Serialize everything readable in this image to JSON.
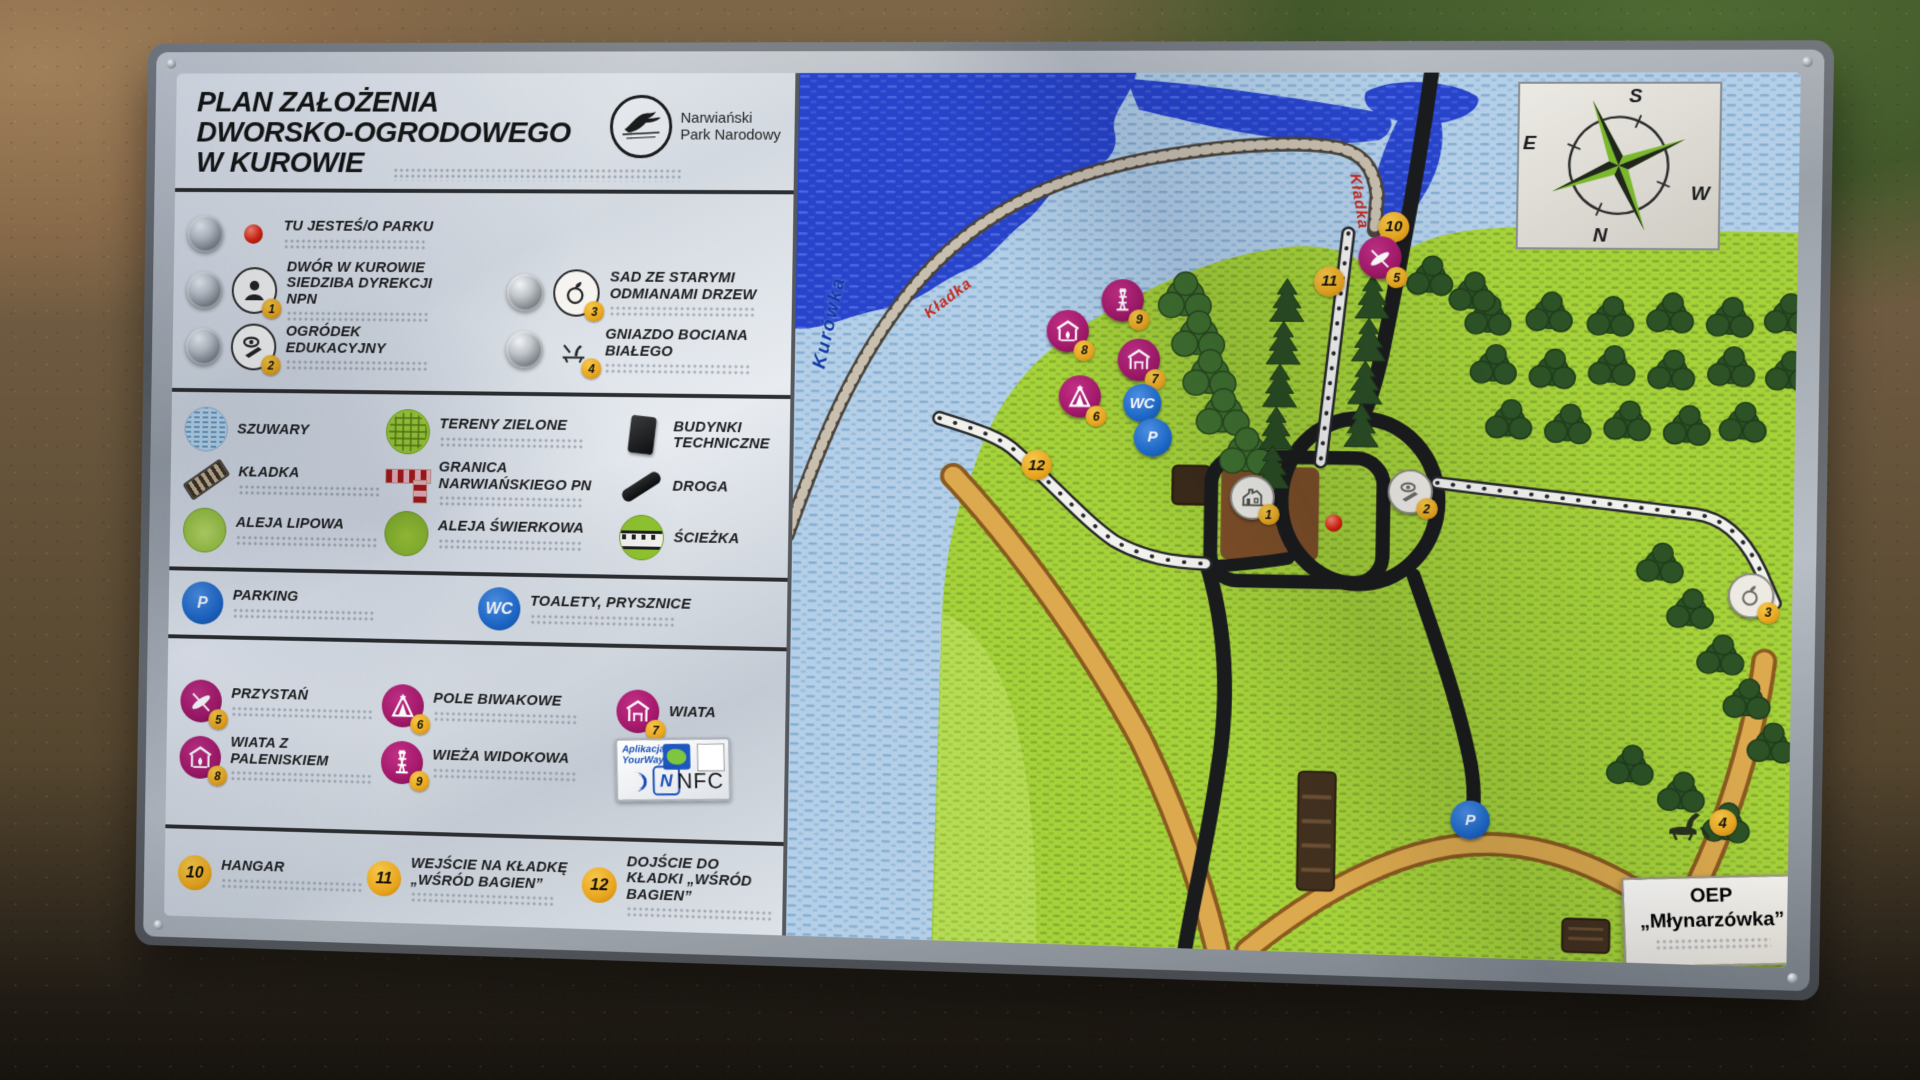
{
  "board": {
    "title_lines": [
      "PLAN ZAŁOŻENIA",
      "DWORSKO-OGRODOWEGO",
      "W KUROWIE"
    ],
    "logo": {
      "park_name_lines": [
        "Narwiański",
        "Park Narodowy"
      ]
    }
  },
  "colors": {
    "magenta": "#a4196b",
    "badge_yellow": "#e9a61f",
    "blue": "#1e6bcc",
    "land_green": "#a5d23a",
    "water_light": "#b7d0e6",
    "river_blue": "#2a47cf",
    "path_orange": "#d9a44a",
    "road_black": "#1a1b1d",
    "red_dot": "#e02412"
  },
  "legend": {
    "sections": [
      {
        "id": "s1",
        "metal": true,
        "items": [
          {
            "icon": "you-are-here",
            "label": "TU JESTEŚ/O PARKU",
            "wide": true,
            "braille": true
          },
          {
            "icon": "poi-dwor",
            "badge": "1",
            "label": "DWÓR W KUROWIE SIEDZIBA DYREKCJI NPN",
            "braille": true
          },
          {
            "icon": "poi-sad",
            "badge": "3",
            "label": "SAD ZE STARYMI ODMIANAMI DRZEW",
            "braille": true
          },
          {
            "icon": "poi-ogrodek",
            "badge": "2",
            "label": "OGRÓDEK EDUKACYJNY",
            "braille": true
          },
          {
            "icon": "poi-gniazdo",
            "badge": "4",
            "label": "GNIAZDO BOCIANA BIAŁEGO",
            "braille": true
          }
        ]
      },
      {
        "id": "s2",
        "items": [
          {
            "icon": "szuwary",
            "label": "SZUWARY"
          },
          {
            "icon": "tereny-zielone",
            "label": "TERENY ZIELONE",
            "braille": true
          },
          {
            "icon": "budynki",
            "label": "BUDYNKI TECHNICZNE"
          },
          {
            "icon": "kladka",
            "label": "KŁADKA",
            "braille": true
          },
          {
            "icon": "granica",
            "label": "GRANICA NARWIAŃSKIEGO PN",
            "braille": true
          },
          {
            "icon": "droga",
            "label": "DROGA"
          },
          {
            "icon": "aleja-lipowa",
            "label": "ALEJA LIPOWA",
            "braille": true
          },
          {
            "icon": "aleja-swierkowa",
            "label": "ALEJA ŚWIERKOWA",
            "braille": true
          },
          {
            "icon": "sciezka",
            "label": "ŚCIEŻKA"
          }
        ]
      },
      {
        "id": "s3",
        "items": [
          {
            "icon": "parking",
            "glyph": "P",
            "label": "PARKING",
            "braille": true
          },
          {
            "icon": "wc",
            "glyph": "WC",
            "label": "TOALETY, PRYSZNICE",
            "braille": true
          }
        ]
      },
      {
        "id": "s4",
        "items": [
          {
            "icon": "przystan",
            "badge": "5",
            "label": "PRZYSTAŃ",
            "braille": true
          },
          {
            "icon": "pole-biwakowe",
            "badge": "6",
            "label": "POLE BIWAKOWE",
            "braille": true
          },
          {
            "icon": "wiata",
            "badge": "7",
            "label": "WIATA"
          },
          {
            "icon": "wiata-paleniskiem",
            "badge": "8",
            "label": "WIATA Z PALENISKIEM",
            "braille": true
          },
          {
            "icon": "wieza",
            "badge": "9",
            "label": "WIEŻA WIDOKOWA",
            "braille": true
          },
          {
            "icon": "nfc"
          }
        ]
      },
      {
        "id": "s5",
        "items": [
          {
            "icon": "badge-only",
            "badge": "10",
            "label": "HANGAR",
            "braille": true
          },
          {
            "icon": "badge-only",
            "badge": "11",
            "label": "WEJŚCIE NA KŁADKĘ „WŚRÓD BAGIEN”",
            "braille": true
          },
          {
            "icon": "badge-only",
            "badge": "12",
            "label": "DOJŚCIE DO KŁADKI „WŚRÓD BAGIEN”",
            "braille": true
          }
        ]
      }
    ]
  },
  "nfc": {
    "app_line1": "Aplikacja",
    "app_line2": "YourWay",
    "label": "NFC"
  },
  "map": {
    "compass": {
      "top": "S",
      "left": "E",
      "right": "W",
      "bottom": "N"
    },
    "labels": [
      {
        "text": "Kurówka",
        "x": 2.5,
        "y": 33,
        "rot": -78,
        "cls": "water-label"
      },
      {
        "text": "Kładka",
        "x": 13.5,
        "y": 27,
        "rot": -38,
        "cls": "red-label"
      },
      {
        "text": "Kładka",
        "x": 56.5,
        "y": 10.5,
        "rot": 80,
        "cls": "red-label"
      }
    ],
    "oep_lines": [
      "OEP",
      "„Młynarzówka”"
    ],
    "markers": [
      {
        "t": "badge",
        "label": "10",
        "x": 60.5,
        "y": 17.5
      },
      {
        "t": "poi",
        "icon": "przystan",
        "badge": "5",
        "x": 59.2,
        "y": 21.0
      },
      {
        "t": "badge",
        "label": "11",
        "x": 54.2,
        "y": 23.7
      },
      {
        "t": "poi",
        "icon": "wieza",
        "badge": "9",
        "x": 33.5,
        "y": 26.0
      },
      {
        "t": "poi",
        "icon": "wiata-paleniskiem",
        "badge": "8",
        "x": 28.0,
        "y": 29.6
      },
      {
        "t": "poi",
        "icon": "wiata",
        "badge": "7",
        "x": 35.2,
        "y": 32.8
      },
      {
        "t": "poi",
        "icon": "pole-biwakowe",
        "badge": "6",
        "x": 29.3,
        "y": 37.1
      },
      {
        "t": "blue",
        "label": "WC",
        "x": 35.6,
        "y": 37.8
      },
      {
        "t": "blue",
        "label": "P",
        "x": 36.7,
        "y": 41.7
      },
      {
        "t": "badge",
        "label": "12",
        "x": 25.0,
        "y": 45.1
      },
      {
        "t": "grey",
        "icon": "map-dwor",
        "badge": "1",
        "x": 46.8,
        "y": 48.4
      },
      {
        "t": "reddot",
        "x": 55.0,
        "y": 51.2
      },
      {
        "t": "grey",
        "icon": "map-ogrodek",
        "badge": "2",
        "x": 62.5,
        "y": 47.5
      },
      {
        "t": "grey",
        "icon": "map-sad",
        "badge": "3",
        "x": 96.0,
        "y": 58.5
      },
      {
        "t": "nest",
        "icon": "gniazdo-dark",
        "badge": "4",
        "x": 91.5,
        "y": 84.0
      },
      {
        "t": "blue",
        "label": "P",
        "x": 69.0,
        "y": 84.5
      }
    ]
  }
}
